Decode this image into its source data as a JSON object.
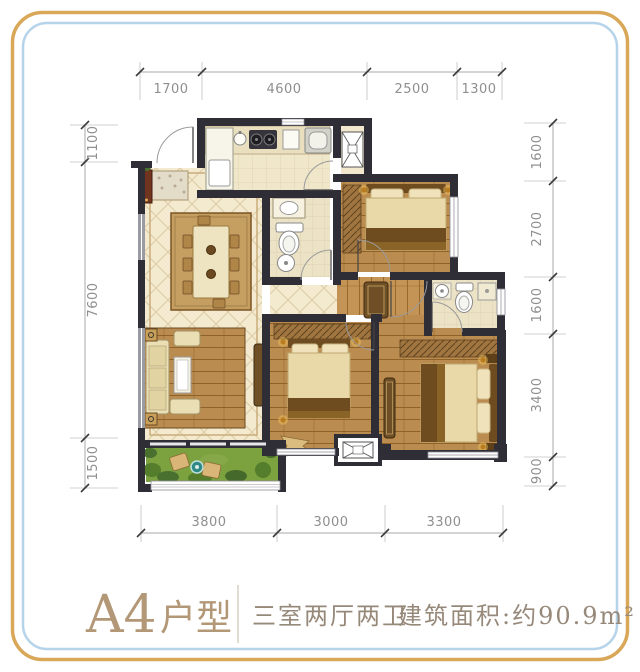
{
  "frame": {
    "outer_border_color": "#d9a758",
    "inner_border_color": "#b5d4ea"
  },
  "floorplan": {
    "dims_top": [
      "1700",
      "4600",
      "2500",
      "1300"
    ],
    "dims_bottom": [
      "3800",
      "3000",
      "3300"
    ],
    "dims_left": [
      "1100",
      "7600",
      "1500"
    ],
    "dims_right": [
      "1600",
      "2700",
      "1600",
      "3400",
      "900"
    ],
    "icons": {
      "service_platform_symbol": "crossed-box",
      "ac_platform_symbol": "crossed-box"
    }
  },
  "footer": {
    "unit_code": "A4",
    "unit_suffix": "户型",
    "layout": "三室两厅两卫",
    "area": "建筑面积:约90.9m²"
  }
}
